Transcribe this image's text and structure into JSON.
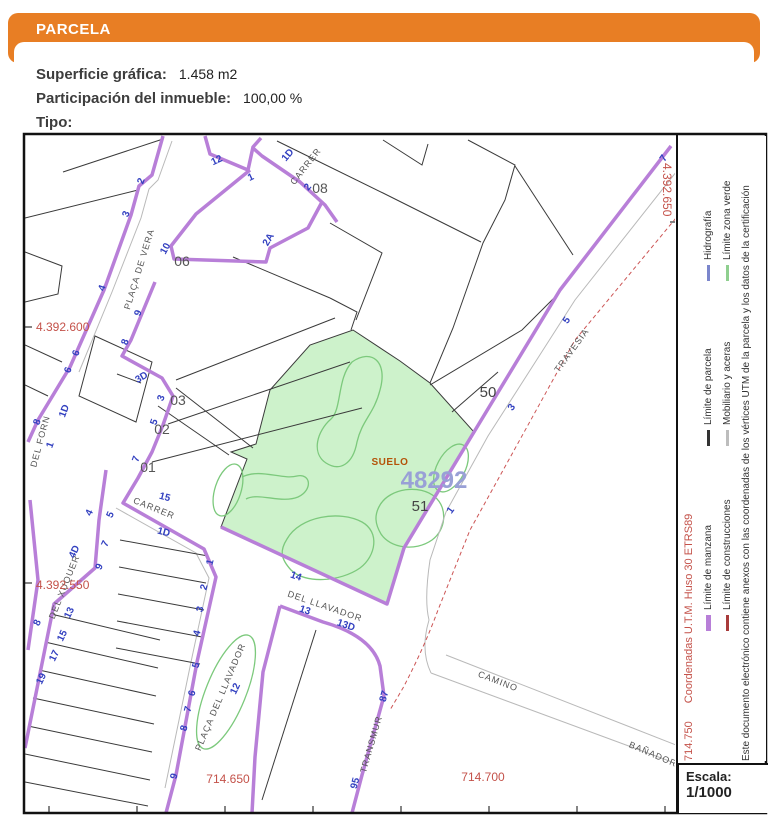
{
  "header": {
    "title": "PARCELA"
  },
  "info": {
    "superficie_label": "Superficie gráfica:",
    "superficie_value": "1.458 m2",
    "participacion_label": "Participación del inmueble:",
    "participacion_value": "100,00 %",
    "tipo_label": "Tipo:",
    "tipo_value": ""
  },
  "colors": {
    "accent_orange": "#E87E24",
    "manzana_purple": "#b87fd8",
    "parcel_green_fill": "#cdf2cb",
    "zona_verde_stroke": "#7cc97c",
    "house_number_blue": "#3240c0",
    "coordinate_red": "#c4524a"
  },
  "map": {
    "parcel_number": "48292",
    "suelo_label": "SUELO",
    "subparcels": [
      "50",
      "51"
    ],
    "labels": [
      {
        "t": "CARRER",
        "x": 308,
        "y": 168,
        "r": -52,
        "c": "street"
      },
      {
        "t": "PLAÇA DE VERA",
        "x": 142,
        "y": 270,
        "r": -73,
        "c": "street"
      },
      {
        "t": "DEL FORN",
        "x": 43,
        "y": 442,
        "r": -75,
        "c": "street"
      },
      {
        "t": "DEL XUQUER",
        "x": 67,
        "y": 588,
        "r": -68,
        "c": "street"
      },
      {
        "t": "CARRER",
        "x": 153,
        "y": 511,
        "r": 22,
        "c": "street"
      },
      {
        "t": "DEL LLAVADOR",
        "x": 324,
        "y": 609,
        "r": 19,
        "c": "street"
      },
      {
        "t": "PLAÇA DEL LLAVADOR",
        "x": 223,
        "y": 698,
        "r": -67,
        "c": "street"
      },
      {
        "t": "TRANSMUR",
        "x": 374,
        "y": 745,
        "r": -74,
        "c": "street"
      },
      {
        "t": "TRAVESIA",
        "x": 574,
        "y": 352,
        "r": -54,
        "c": "street"
      },
      {
        "t": "CAMINO",
        "x": 497,
        "y": 684,
        "r": 21,
        "c": "street"
      },
      {
        "t": "BAÑADOR",
        "x": 652,
        "y": 757,
        "r": 23,
        "c": "street"
      },
      {
        "t": "12",
        "x": 218,
        "y": 163,
        "r": -25,
        "c": "house"
      },
      {
        "t": "1",
        "x": 252,
        "y": 180,
        "r": -25,
        "c": "house"
      },
      {
        "t": "1D",
        "x": 290,
        "y": 157,
        "r": -50,
        "c": "house"
      },
      {
        "t": "2",
        "x": 310,
        "y": 189,
        "r": -50,
        "c": "house"
      },
      {
        "t": "2A",
        "x": 271,
        "y": 241,
        "r": -60,
        "c": "house"
      },
      {
        "t": "2",
        "x": 144,
        "y": 182,
        "r": -70,
        "c": "house"
      },
      {
        "t": "3",
        "x": 129,
        "y": 215,
        "r": -70,
        "c": "house"
      },
      {
        "t": "10",
        "x": 168,
        "y": 250,
        "r": -62,
        "c": "house"
      },
      {
        "t": "9",
        "x": 141,
        "y": 314,
        "r": -70,
        "c": "house"
      },
      {
        "t": "8",
        "x": 128,
        "y": 343,
        "r": -70,
        "c": "house"
      },
      {
        "t": "4",
        "x": 105,
        "y": 289,
        "r": -70,
        "c": "house"
      },
      {
        "t": "6",
        "x": 79,
        "y": 354,
        "r": -70,
        "c": "house"
      },
      {
        "t": "6",
        "x": 71,
        "y": 371,
        "r": -70,
        "c": "house"
      },
      {
        "t": "1D",
        "x": 67,
        "y": 412,
        "r": -70,
        "c": "house"
      },
      {
        "t": "1",
        "x": 53,
        "y": 446,
        "r": -70,
        "c": "house"
      },
      {
        "t": "8",
        "x": 40,
        "y": 423,
        "r": -70,
        "c": "house"
      },
      {
        "t": "3D",
        "x": 143,
        "y": 380,
        "r": -30,
        "c": "house"
      },
      {
        "t": "3",
        "x": 164,
        "y": 399,
        "r": -70,
        "c": "house"
      },
      {
        "t": "5",
        "x": 157,
        "y": 423,
        "r": -70,
        "c": "house"
      },
      {
        "t": "7",
        "x": 139,
        "y": 460,
        "r": -70,
        "c": "house"
      },
      {
        "t": "15",
        "x": 164,
        "y": 500,
        "r": 15,
        "c": "house"
      },
      {
        "t": "1D",
        "x": 163,
        "y": 535,
        "r": 15,
        "c": "house"
      },
      {
        "t": "1",
        "x": 213,
        "y": 563,
        "r": -75,
        "c": "house"
      },
      {
        "t": "2",
        "x": 207,
        "y": 588,
        "r": -75,
        "c": "house"
      },
      {
        "t": "3",
        "x": 203,
        "y": 610,
        "r": -75,
        "c": "house"
      },
      {
        "t": "4",
        "x": 200,
        "y": 634,
        "r": -75,
        "c": "house"
      },
      {
        "t": "5",
        "x": 199,
        "y": 666,
        "r": -75,
        "c": "house"
      },
      {
        "t": "6",
        "x": 195,
        "y": 694,
        "r": -75,
        "c": "house"
      },
      {
        "t": "7",
        "x": 191,
        "y": 710,
        "r": -75,
        "c": "house"
      },
      {
        "t": "8",
        "x": 187,
        "y": 729,
        "r": -75,
        "c": "house"
      },
      {
        "t": "9",
        "x": 177,
        "y": 777,
        "r": -75,
        "c": "house"
      },
      {
        "t": "5",
        "x": 113,
        "y": 516,
        "r": -65,
        "c": "house"
      },
      {
        "t": "7",
        "x": 108,
        "y": 545,
        "r": -65,
        "c": "house"
      },
      {
        "t": "9",
        "x": 102,
        "y": 568,
        "r": -65,
        "c": "house"
      },
      {
        "t": "4",
        "x": 92,
        "y": 514,
        "r": -65,
        "c": "house"
      },
      {
        "t": "4D",
        "x": 77,
        "y": 553,
        "r": -65,
        "c": "house"
      },
      {
        "t": "8",
        "x": 40,
        "y": 624,
        "r": -65,
        "c": "house"
      },
      {
        "t": "13",
        "x": 72,
        "y": 614,
        "r": -65,
        "c": "house"
      },
      {
        "t": "15",
        "x": 65,
        "y": 637,
        "r": -65,
        "c": "house"
      },
      {
        "t": "17",
        "x": 57,
        "y": 657,
        "r": -65,
        "c": "house"
      },
      {
        "t": "19",
        "x": 44,
        "y": 680,
        "r": -65,
        "c": "house"
      },
      {
        "t": "14",
        "x": 295,
        "y": 579,
        "r": 19,
        "c": "house"
      },
      {
        "t": "13",
        "x": 304,
        "y": 613,
        "r": 19,
        "c": "house"
      },
      {
        "t": "13D",
        "x": 345,
        "y": 628,
        "r": 19,
        "c": "house"
      },
      {
        "t": "12",
        "x": 238,
        "y": 690,
        "r": -65,
        "c": "house"
      },
      {
        "t": "87",
        "x": 387,
        "y": 697,
        "r": -75,
        "c": "house"
      },
      {
        "t": "95",
        "x": 358,
        "y": 784,
        "r": -75,
        "c": "house"
      },
      {
        "t": "1",
        "x": 453,
        "y": 512,
        "r": -54,
        "c": "house"
      },
      {
        "t": "3",
        "x": 514,
        "y": 409,
        "r": -54,
        "c": "house"
      },
      {
        "t": "5",
        "x": 569,
        "y": 322,
        "r": -54,
        "c": "house"
      },
      {
        "t": "7",
        "x": 666,
        "y": 160,
        "r": -54,
        "c": "house"
      },
      {
        "t": "06",
        "x": 182,
        "y": 266,
        "r": 0,
        "c": "block"
      },
      {
        "t": "08",
        "x": 320,
        "y": 193,
        "r": 0,
        "c": "block"
      },
      {
        "t": "03",
        "x": 178,
        "y": 405,
        "r": 0,
        "c": "block"
      },
      {
        "t": "02",
        "x": 162,
        "y": 434,
        "r": 0,
        "c": "block"
      },
      {
        "t": "01",
        "x": 148,
        "y": 472,
        "r": 0,
        "c": "block"
      },
      {
        "t": "50",
        "x": 488,
        "y": 397,
        "r": 0,
        "c": "sub"
      },
      {
        "t": "51",
        "x": 420,
        "y": 511,
        "r": 0,
        "c": "sub"
      },
      {
        "t": "SUELO",
        "x": 390,
        "y": 465,
        "r": 0,
        "c": "suelo"
      },
      {
        "t": "48292",
        "x": 434,
        "y": 488,
        "r": 0,
        "c": "pnum"
      },
      {
        "t": "4.392.600",
        "x": 36,
        "y": 331,
        "r": 0,
        "c": "coord",
        "a": "start"
      },
      {
        "t": "4.392.550",
        "x": 36,
        "y": 589,
        "r": 0,
        "c": "coord",
        "a": "start"
      },
      {
        "t": "714.650",
        "x": 228,
        "y": 783,
        "r": 0,
        "c": "coord"
      },
      {
        "t": "714.700",
        "x": 483,
        "y": 781,
        "r": 0,
        "c": "coord"
      },
      {
        "t": "4.392.650",
        "x": 663,
        "y": 163,
        "r": 90,
        "c": "coord",
        "a": "start"
      }
    ],
    "bottom_ticks": [
      49,
      137,
      225,
      313,
      401,
      489,
      577,
      665
    ],
    "left_ticks": [
      327,
      583
    ],
    "right_ticks": [
      222
    ]
  },
  "legend": {
    "corner_coordinate": "714.750",
    "coords_note": "Coordenadas U.T.M. Huso 30 ETRS89",
    "items_row1": [
      {
        "label": "Límite de manzana",
        "color": "#b87fd8",
        "thick": true
      },
      {
        "label": "Límite de parcela",
        "color": "#333333",
        "thick": false
      },
      {
        "label": "Hidrografía",
        "color": "#7b86cc",
        "thick": false
      }
    ],
    "items_row2": [
      {
        "label": "Límite de construcciones",
        "color": "#a83b3b",
        "thick": false
      },
      {
        "label": "Mobiliario y aceras",
        "color": "#bdbdbd",
        "thick": false
      },
      {
        "label": "Límite zona verde",
        "color": "#8fcf8f",
        "thick": false
      }
    ],
    "footer": "Este documento electrónico contiene anexos con las coordenadas de los vértices UTM de la parcela y los datos de la certificación"
  },
  "scale": {
    "label": "Escala:",
    "value": "1/1000"
  }
}
